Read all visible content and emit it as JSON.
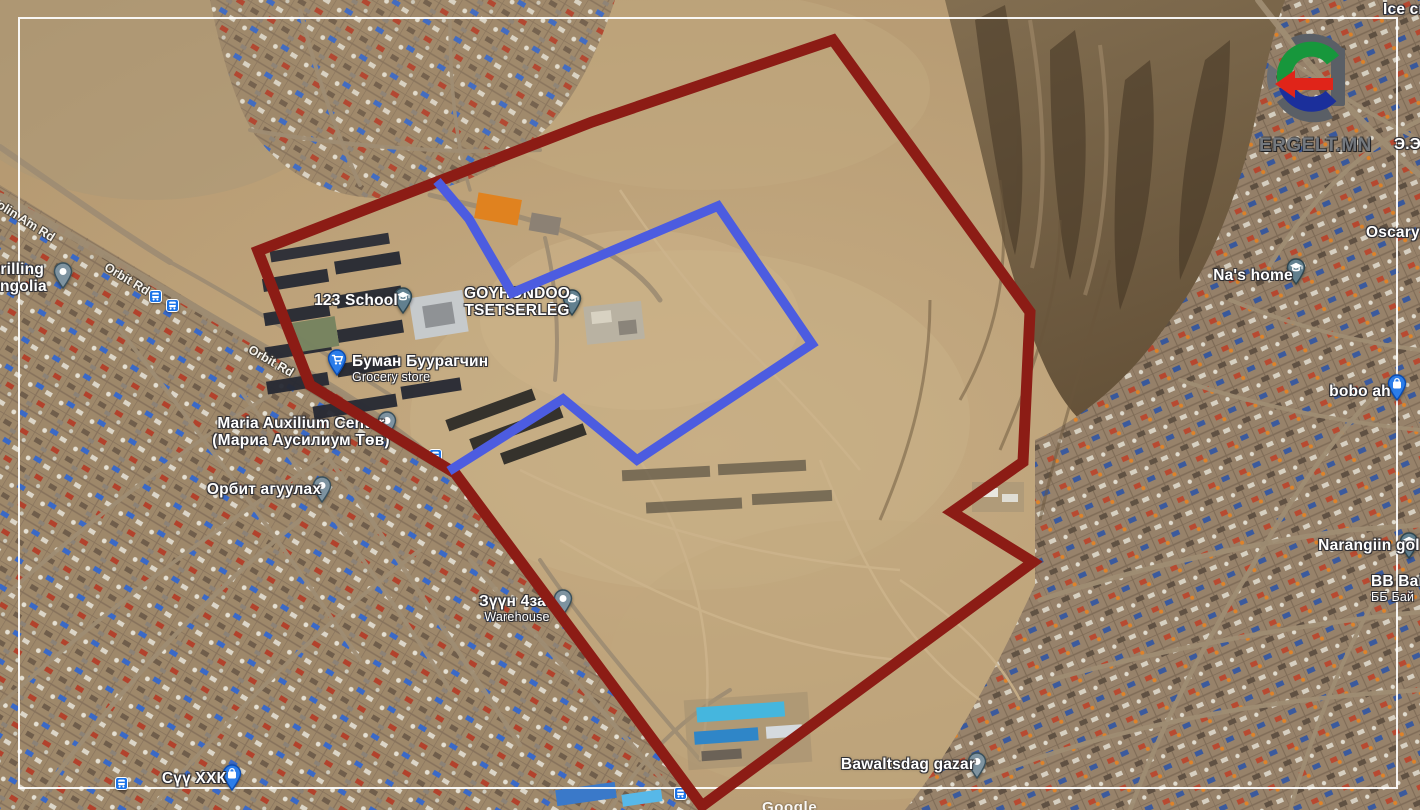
{
  "brand": {
    "logo_text": "ERGELT.MN"
  },
  "attribution": {
    "watermark": "Google"
  },
  "map": {
    "road_labels": [
      {
        "text": "olin Am Rd",
        "x": 26,
        "y": 221,
        "rotate": 32
      },
      {
        "text": "Orbit Rd",
        "x": 127,
        "y": 279,
        "rotate": 31
      },
      {
        "text": "Orbit Rd",
        "x": 271,
        "y": 361,
        "rotate": 30
      }
    ],
    "pois": [
      {
        "name": "i Drilling",
        "name2": "Mongolia",
        "tx": 12,
        "ty": 261,
        "pin_type": "dot",
        "pin_x": 63,
        "pin_y": 272
      },
      {
        "name": "123 School",
        "tx": 356,
        "ty": 292,
        "pin_type": "edu",
        "pin_x": 403,
        "pin_y": 297
      },
      {
        "name": "GOYHONDOO",
        "name2": "TSETSERLEG",
        "tx": 517,
        "ty": 285,
        "pin_type": "edu",
        "pin_x": 572,
        "pin_y": 299,
        "marker_x": 551,
        "marker_y": 306
      },
      {
        "name": "Буман Буурагчин",
        "sub": "Grocery store",
        "anchor": "left",
        "lx": 352,
        "ty": 353,
        "pin_type": "cart",
        "pin_x": 337,
        "pin_y": 359
      },
      {
        "name": "Maria Auxilium Center",
        "name2": "(Мариа Аусилиум Төв)",
        "tx": 301,
        "ty": 415,
        "pin_type": "dot",
        "pin_x": 387,
        "pin_y": 421
      },
      {
        "name": "Орбит агуулах",
        "tx": 264,
        "ty": 481,
        "pin_type": "dot",
        "pin_x": 322,
        "pin_y": 486
      },
      {
        "name": "Зүүн 4за..",
        "sub": "Warehouse",
        "tx": 517,
        "ty": 593,
        "pin_type": "dot",
        "pin_x": 563,
        "pin_y": 599
      },
      {
        "name": "Сүү ХХК",
        "tx": 194,
        "ty": 770,
        "pin_type": "bag",
        "pin_x": 232,
        "pin_y": 774
      },
      {
        "name": "Bawaltsdag gazar",
        "tx": 908,
        "ty": 756,
        "pin_type": "dot",
        "pin_x": 977,
        "pin_y": 762
      },
      {
        "name": "Na's home",
        "tx": 1253,
        "ty": 267,
        "pin_type": "edu",
        "pin_x": 1296,
        "pin_y": 268
      },
      {
        "name": "Oscaryn",
        "anchor": "left",
        "lx": 1366,
        "ty": 224
      },
      {
        "name": "bobo ah",
        "tx": 1360,
        "ty": 383,
        "pin_type": "bag",
        "pin_x": 1397,
        "pin_y": 384
      },
      {
        "name": "Narangiin gol",
        "tx": 1369,
        "ty": 537,
        "pin_type": "edu",
        "pin_x": 1409,
        "pin_y": 542
      },
      {
        "name": "ВВ Вайц",
        "sub": "ББ Бай",
        "anchor": "left",
        "lx": 1371,
        "ty": 573
      },
      {
        "name": "Ice crea",
        "anchor": "left",
        "lx": 1383,
        "ty": 1
      },
      {
        "name": "Э.Эр",
        "anchor": "left",
        "lx": 1394,
        "ty": 136
      }
    ],
    "bus_stops": [
      [
        155,
        296
      ],
      [
        172,
        305
      ],
      [
        435,
        455
      ],
      [
        680,
        793
      ],
      [
        121,
        783
      ]
    ]
  },
  "overlays": {
    "red_polygon": {
      "color": "#8c1c15",
      "stroke_width": 11,
      "closed": true,
      "points": [
        [
          833,
          40
        ],
        [
          1030,
          312
        ],
        [
          1023,
          462
        ],
        [
          952,
          512
        ],
        [
          1033,
          562
        ],
        [
          702,
          806
        ],
        [
          455,
          473
        ],
        [
          310,
          385
        ],
        [
          258,
          251
        ],
        [
          592,
          122
        ]
      ]
    },
    "blue_polyline": {
      "color": "#4c5ce0",
      "stroke_width": 9.5,
      "closed": false,
      "points": [
        [
          437,
          181
        ],
        [
          469,
          219
        ],
        [
          512,
          293
        ],
        [
          718,
          206
        ],
        [
          812,
          344
        ],
        [
          637,
          460
        ],
        [
          563,
          399
        ],
        [
          449,
          471
        ]
      ]
    }
  }
}
